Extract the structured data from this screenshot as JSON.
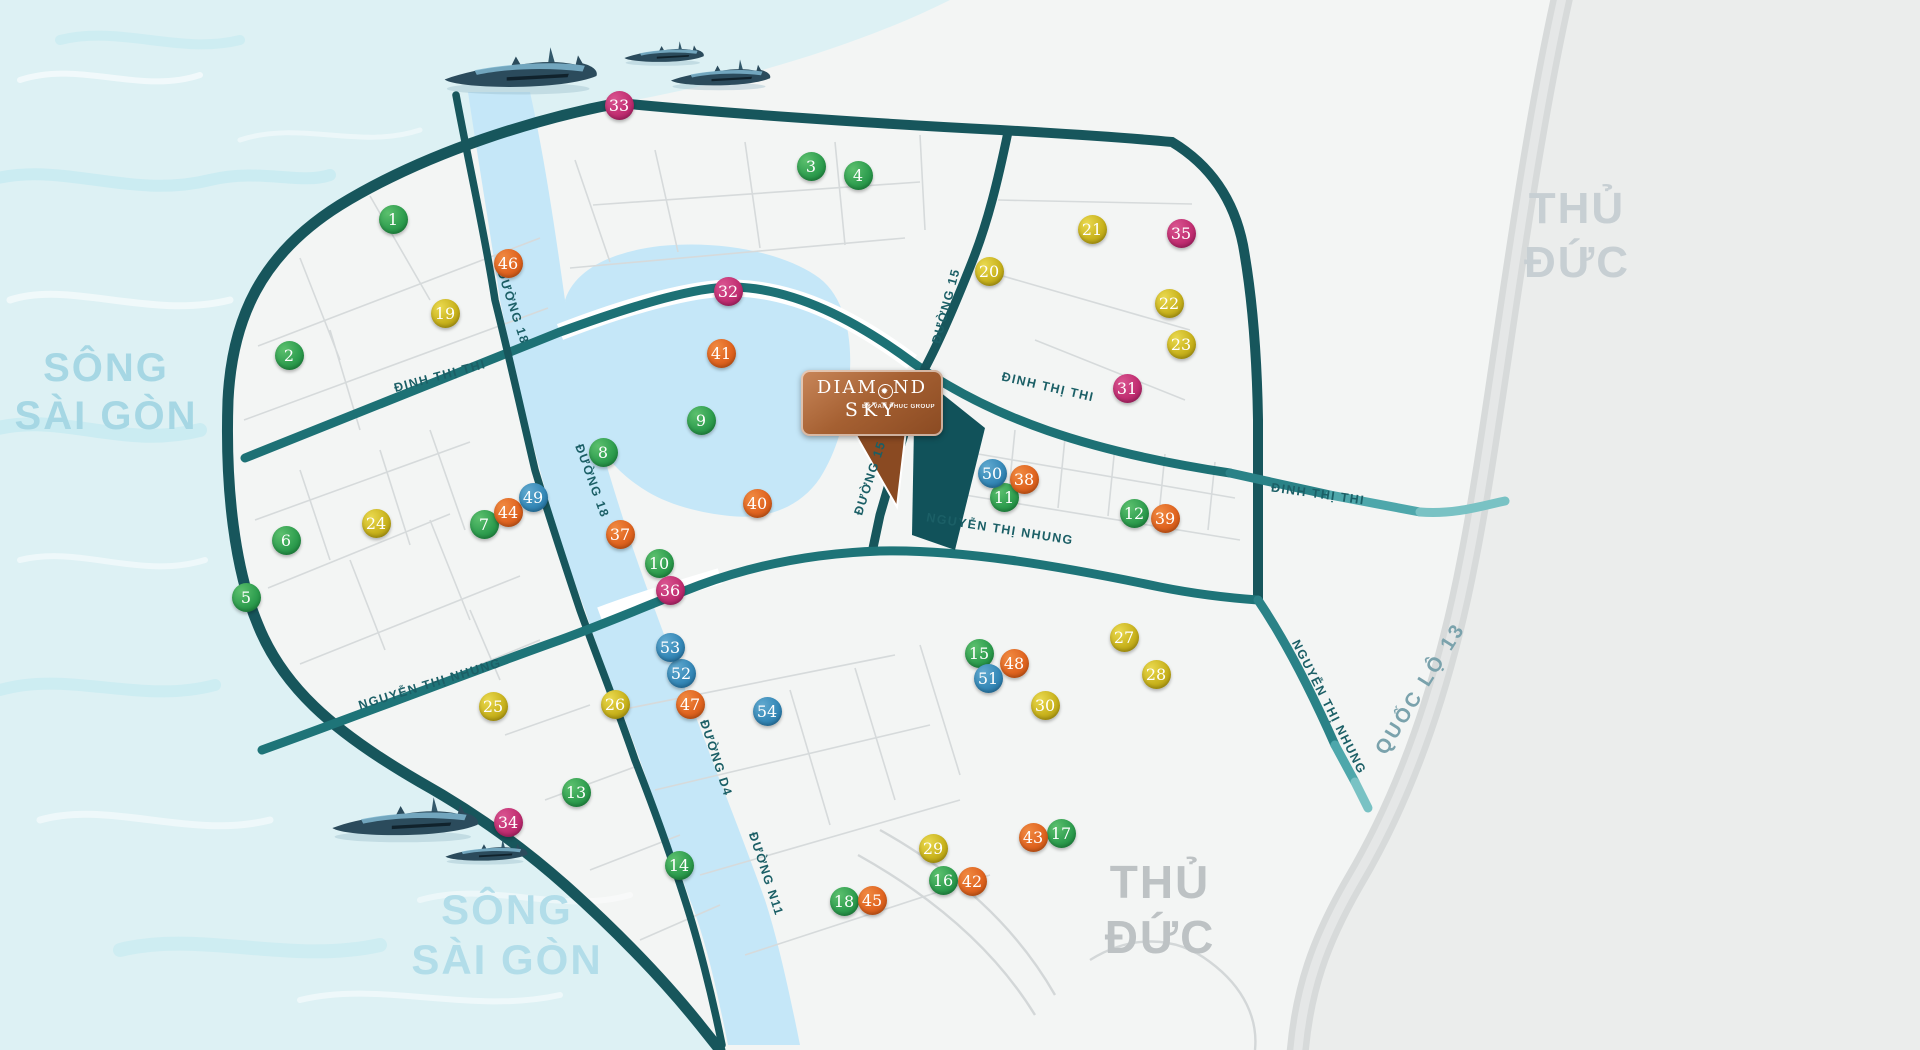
{
  "map": {
    "project_logo": {
      "line1_pre": "DIAM",
      "ornament": "✹",
      "line1_post": "ND",
      "line2": "SKY",
      "tagline": "BY VAN PHUC GROUP"
    },
    "regions": [
      {
        "id": "song-saigon-left",
        "lines": [
          "SÔNG",
          "SÀI GÒN"
        ],
        "x": 106,
        "y": 366,
        "size": 40,
        "lh": 48,
        "color": "#a6d7e4"
      },
      {
        "id": "song-saigon-bottom",
        "lines": [
          "SÔNG",
          "SÀI GÒN"
        ],
        "x": 507,
        "y": 908,
        "size": 42,
        "lh": 50,
        "color": "#b2dde9"
      },
      {
        "id": "thu-duc-top",
        "lines": [
          "THỦ",
          "ĐỨC"
        ],
        "x": 1577,
        "y": 206,
        "size": 44,
        "lh": 54,
        "color": "#c7cfd3"
      },
      {
        "id": "thu-duc-bottom",
        "lines": [
          "THỦ",
          "ĐỨC"
        ],
        "x": 1160,
        "y": 880,
        "size": 46,
        "lh": 55,
        "color": "#bdc2c4"
      }
    ],
    "streets": [
      {
        "text": "ĐINH THỊ THI",
        "x": 440,
        "y": 376,
        "rot": -15
      },
      {
        "text": "ĐINH THỊ THI",
        "x": 1048,
        "y": 387,
        "rot": 13
      },
      {
        "text": "ĐINH THỊ THI",
        "x": 1318,
        "y": 494,
        "rot": 8
      },
      {
        "text": "ĐƯỜNG 15",
        "x": 946,
        "y": 306,
        "rot": -75
      },
      {
        "text": "ĐƯỜNG 15",
        "x": 870,
        "y": 478,
        "rot": -72
      },
      {
        "text": "ĐƯỜNG 18",
        "x": 513,
        "y": 307,
        "rot": 72
      },
      {
        "text": "ĐƯỜNG 18",
        "x": 592,
        "y": 481,
        "rot": 70
      },
      {
        "text": "ĐƯỜNG D4",
        "x": 716,
        "y": 758,
        "rot": 72
      },
      {
        "text": "ĐƯỜNG N11",
        "x": 766,
        "y": 874,
        "rot": 72
      },
      {
        "text": "NGUYỄN THỊ NHUNG",
        "x": 430,
        "y": 684,
        "rot": -17
      },
      {
        "text": "NGUYỄN THỊ NHUNG",
        "x": 1000,
        "y": 529,
        "rot": 9
      },
      {
        "text": "NGUYỄN THỊ NHUNG",
        "x": 1329,
        "y": 707,
        "rot": 63
      },
      {
        "text": "QUỐC LỘ 13",
        "x": 1421,
        "y": 689,
        "rot": -58,
        "cls": "highway"
      }
    ],
    "marker_groups": {
      "green": {
        "light": "#5cc06e",
        "base": "#2f9e4f",
        "dark": "#137a35"
      },
      "gold": {
        "light": "#ead94f",
        "base": "#c9b31d",
        "dark": "#9d8a08"
      },
      "pink": {
        "light": "#d95490",
        "base": "#c22f72",
        "dark": "#99175a"
      },
      "orange": {
        "light": "#f08a42",
        "base": "#e06420",
        "dark": "#b84b0e"
      },
      "blue": {
        "light": "#61a9cf",
        "base": "#3689b8",
        "dark": "#1c6694"
      }
    },
    "markers": [
      {
        "n": 1,
        "g": "green",
        "x": 393,
        "y": 219
      },
      {
        "n": 2,
        "g": "green",
        "x": 289,
        "y": 355
      },
      {
        "n": 3,
        "g": "green",
        "x": 811,
        "y": 166
      },
      {
        "n": 4,
        "g": "green",
        "x": 858,
        "y": 175
      },
      {
        "n": 5,
        "g": "green",
        "x": 246,
        "y": 597
      },
      {
        "n": 6,
        "g": "green",
        "x": 286,
        "y": 540
      },
      {
        "n": 7,
        "g": "green",
        "x": 484,
        "y": 524
      },
      {
        "n": 8,
        "g": "green",
        "x": 603,
        "y": 452
      },
      {
        "n": 9,
        "g": "green",
        "x": 701,
        "y": 420
      },
      {
        "n": 10,
        "g": "green",
        "x": 659,
        "y": 563
      },
      {
        "n": 11,
        "g": "green",
        "x": 1004,
        "y": 497
      },
      {
        "n": 12,
        "g": "green",
        "x": 1134,
        "y": 513
      },
      {
        "n": 13,
        "g": "green",
        "x": 576,
        "y": 792
      },
      {
        "n": 14,
        "g": "green",
        "x": 679,
        "y": 865
      },
      {
        "n": 15,
        "g": "green",
        "x": 979,
        "y": 653
      },
      {
        "n": 16,
        "g": "green",
        "x": 943,
        "y": 880
      },
      {
        "n": 17,
        "g": "green",
        "x": 1061,
        "y": 833
      },
      {
        "n": 18,
        "g": "green",
        "x": 844,
        "y": 901
      },
      {
        "n": 19,
        "g": "gold",
        "x": 445,
        "y": 313
      },
      {
        "n": 20,
        "g": "gold",
        "x": 989,
        "y": 271
      },
      {
        "n": 21,
        "g": "gold",
        "x": 1092,
        "y": 229
      },
      {
        "n": 22,
        "g": "gold",
        "x": 1169,
        "y": 303
      },
      {
        "n": 23,
        "g": "gold",
        "x": 1181,
        "y": 344
      },
      {
        "n": 24,
        "g": "gold",
        "x": 376,
        "y": 523
      },
      {
        "n": 25,
        "g": "gold",
        "x": 493,
        "y": 706
      },
      {
        "n": 26,
        "g": "gold",
        "x": 615,
        "y": 704
      },
      {
        "n": 27,
        "g": "gold",
        "x": 1124,
        "y": 637
      },
      {
        "n": 28,
        "g": "gold",
        "x": 1156,
        "y": 674
      },
      {
        "n": 29,
        "g": "gold",
        "x": 933,
        "y": 848
      },
      {
        "n": 30,
        "g": "gold",
        "x": 1045,
        "y": 705
      },
      {
        "n": 31,
        "g": "pink",
        "x": 1127,
        "y": 388
      },
      {
        "n": 32,
        "g": "pink",
        "x": 728,
        "y": 291
      },
      {
        "n": 33,
        "g": "pink",
        "x": 619,
        "y": 105
      },
      {
        "n": 34,
        "g": "pink",
        "x": 508,
        "y": 822
      },
      {
        "n": 35,
        "g": "pink",
        "x": 1181,
        "y": 233
      },
      {
        "n": 36,
        "g": "pink",
        "x": 670,
        "y": 590
      },
      {
        "n": 37,
        "g": "orange",
        "x": 620,
        "y": 534
      },
      {
        "n": 38,
        "g": "orange",
        "x": 1024,
        "y": 479
      },
      {
        "n": 39,
        "g": "orange",
        "x": 1165,
        "y": 518
      },
      {
        "n": 40,
        "g": "orange",
        "x": 757,
        "y": 503
      },
      {
        "n": 41,
        "g": "orange",
        "x": 721,
        "y": 353
      },
      {
        "n": 42,
        "g": "orange",
        "x": 972,
        "y": 881
      },
      {
        "n": 43,
        "g": "orange",
        "x": 1033,
        "y": 837
      },
      {
        "n": 44,
        "g": "orange",
        "x": 508,
        "y": 512
      },
      {
        "n": 45,
        "g": "orange",
        "x": 872,
        "y": 900
      },
      {
        "n": 46,
        "g": "orange",
        "x": 508,
        "y": 263
      },
      {
        "n": 47,
        "g": "orange",
        "x": 690,
        "y": 704
      },
      {
        "n": 48,
        "g": "orange",
        "x": 1014,
        "y": 663
      },
      {
        "n": 49,
        "g": "blue",
        "x": 533,
        "y": 497
      },
      {
        "n": 50,
        "g": "blue",
        "x": 992,
        "y": 473
      },
      {
        "n": 51,
        "g": "blue",
        "x": 988,
        "y": 678
      },
      {
        "n": 52,
        "g": "blue",
        "x": 681,
        "y": 673
      },
      {
        "n": 53,
        "g": "blue",
        "x": 670,
        "y": 647
      },
      {
        "n": 54,
        "g": "blue",
        "x": 767,
        "y": 711
      }
    ]
  }
}
